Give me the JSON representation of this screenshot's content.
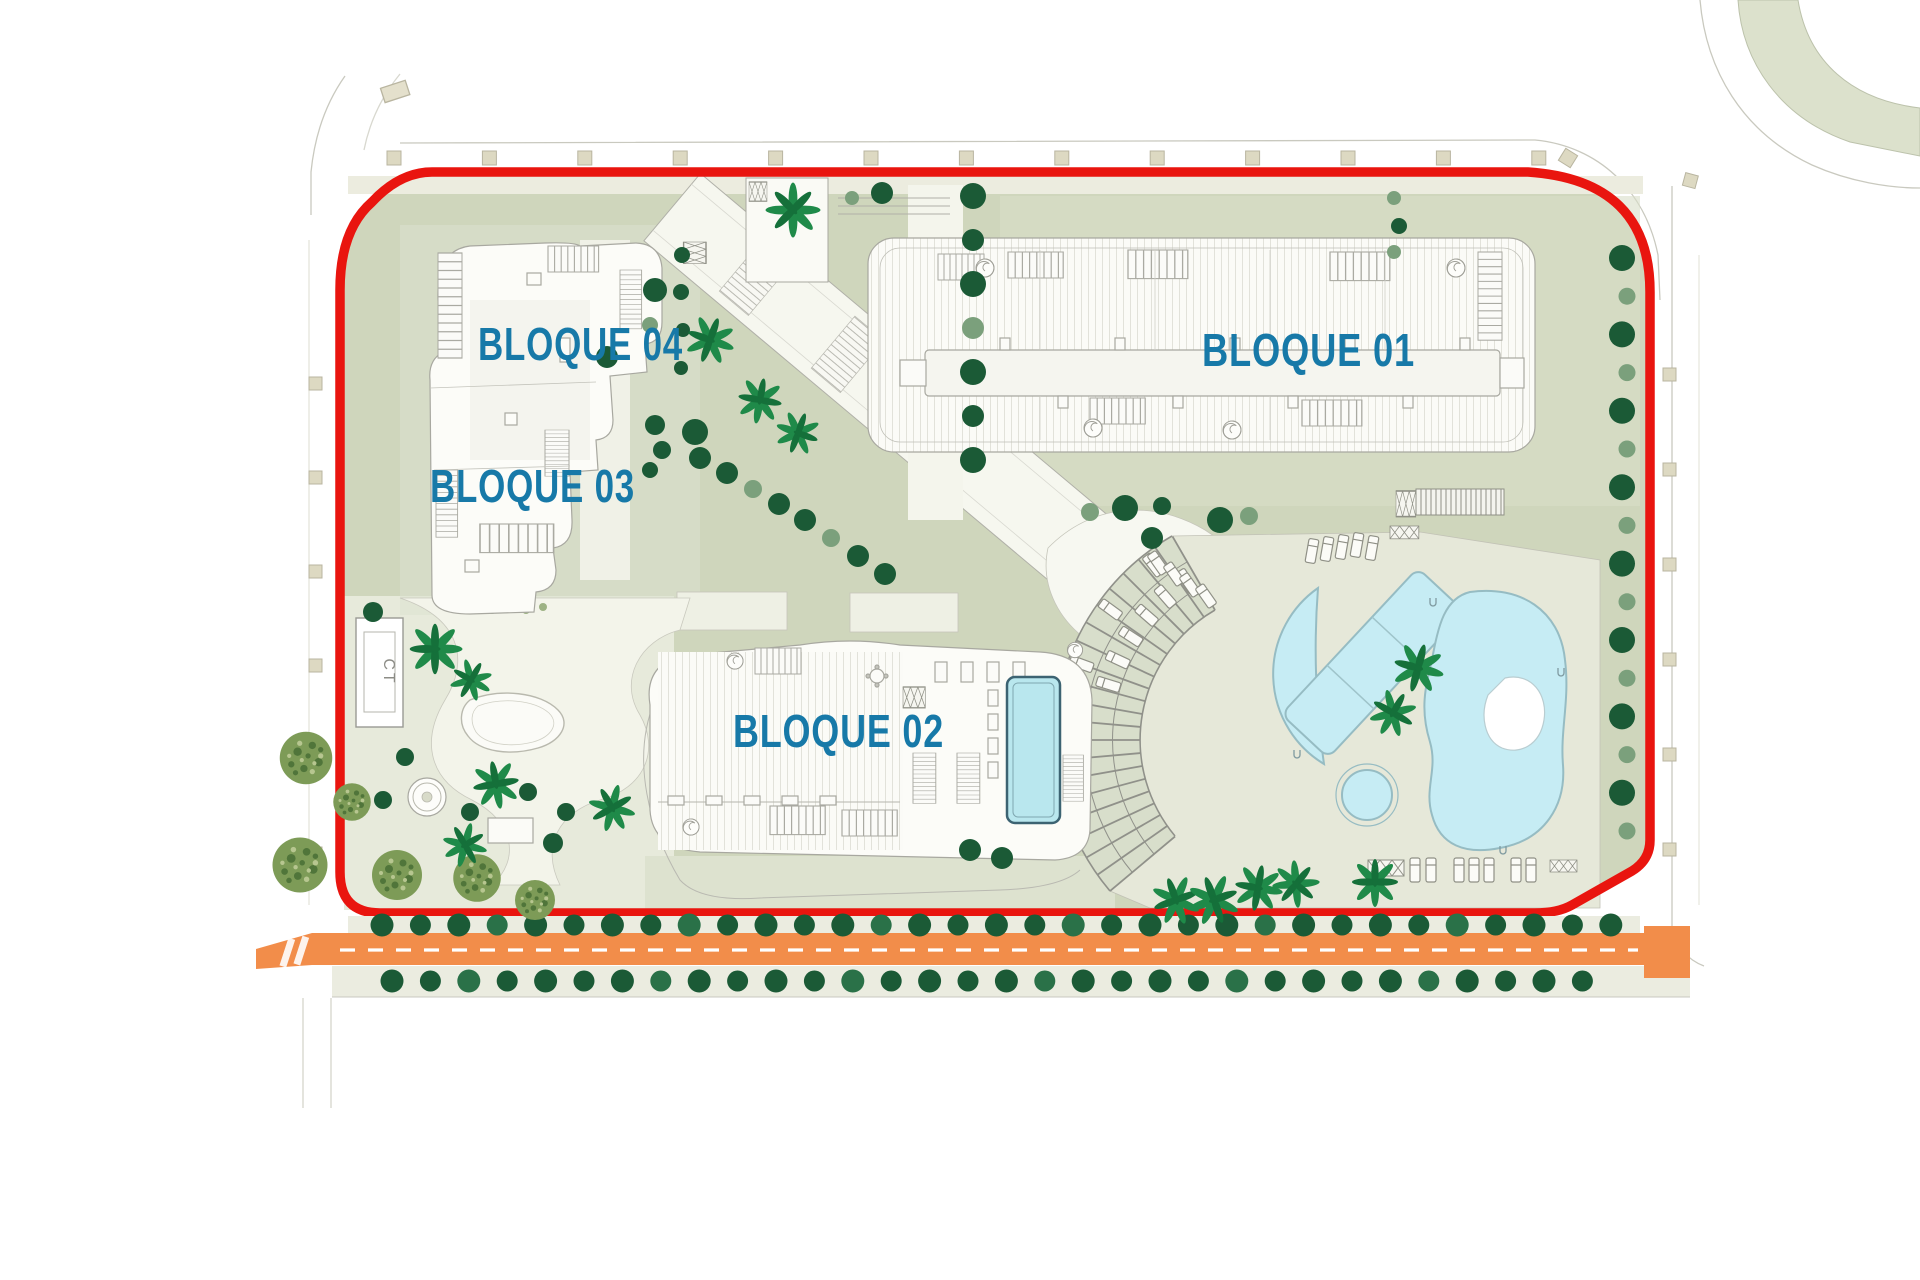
{
  "plan": {
    "blocks": [
      {
        "id": "block-01",
        "label": "BLOQUE 01"
      },
      {
        "id": "block-02",
        "label": "BLOQUE 02"
      },
      {
        "id": "block-03",
        "label": "BLOQUE 03"
      },
      {
        "id": "block-04",
        "label": "BLOQUE 04"
      }
    ],
    "transformer_label": "CT"
  },
  "colors": {
    "boundary_red": "#e9150f",
    "road_orange": "#f28d4a",
    "road_dash_white": "#ffffff",
    "label_teal": "#1779a8",
    "pool_blue": "#c6ecf4",
    "pool_outline": "#96bcc3",
    "rooftop_pool_outline": "#3c6372",
    "landscape_sage": "#cfd6bc",
    "deck_beige": "#e6e8d9",
    "sidewalk_beige": "#ebece0",
    "square_beige": "#ddd9c2",
    "tree_dark": "#1b5a36",
    "tree_mid": "#2a7148",
    "tree_sage": "#7ba07c",
    "textured_tree_olive": "#7d9b57",
    "palm_green": "#1f8a49",
    "building_outline_gray": "#a8a8a0",
    "spoke_gray": "#90918a",
    "transformer_text_gray": "#8c8c86"
  }
}
